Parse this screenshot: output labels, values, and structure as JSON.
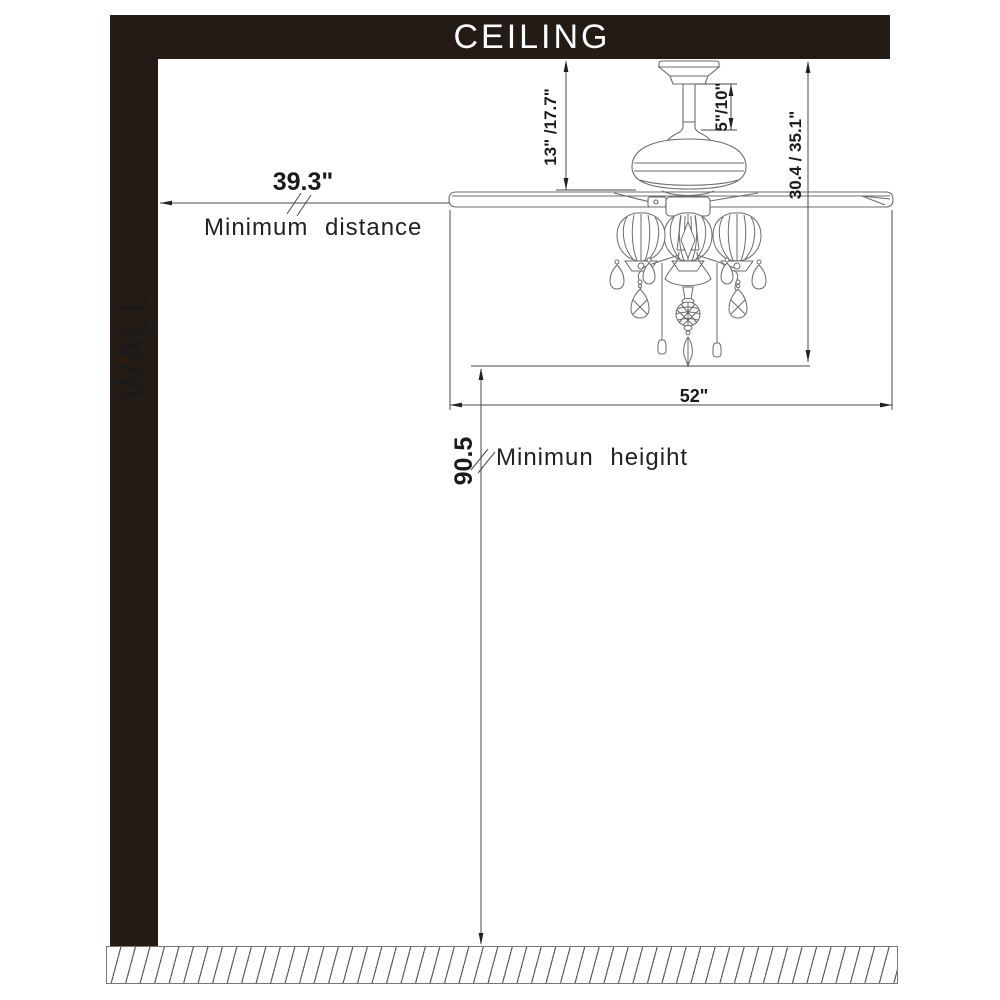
{
  "diagram": {
    "title": "Ceiling fan mounting clearance diagram",
    "ceiling_label": "CEILING",
    "wall_label": "WALL",
    "dimensions": {
      "canopy_to_blades": "13\" /17.7\"",
      "downrod_length": "5\"/10\"",
      "ceiling_to_light_bottom": "30.4 / 35.1\"",
      "blade_sweep": "52\"",
      "wall_distance_value": "39.3\"",
      "wall_distance_label": "Minimum distance",
      "floor_height_value": "90.5",
      "floor_height_label": "Minimun heigiht"
    },
    "colors": {
      "structure_fill": "#241b15",
      "label_on_dark": "#ffffff",
      "drawing_line": "#6b6b6b",
      "dimension_line": "#4a4a4a",
      "dimension_text": "#1a1a1a"
    }
  }
}
